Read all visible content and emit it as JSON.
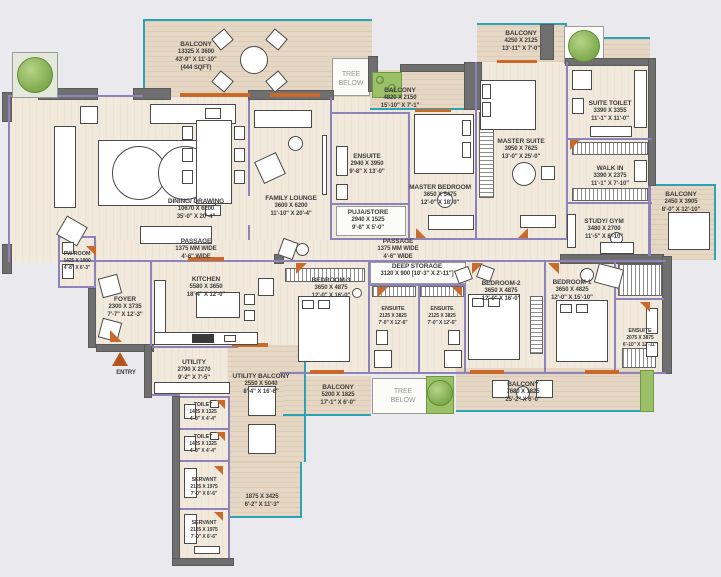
{
  "colors": {
    "bg": "#e9e9ee",
    "floor": "#f1e9dc",
    "balcony": "#e5d7c3",
    "wall": "#6f6f6f",
    "purple": "#8d82ba",
    "teal": "#2ba3b5",
    "orange": "#c96a2a",
    "entry": "#b5541f",
    "green": "#9cc068",
    "text": "#3c3c3c"
  },
  "labels": [
    {
      "id": "balcony-top-left",
      "x": 196,
      "y": 57,
      "lines": [
        "BALCONY",
        "13325 X 3600",
        "43'-9\" X 11'-10\"",
        "(444 SQFT)"
      ]
    },
    {
      "id": "tree-below-top",
      "x": 351,
      "y": 79,
      "cls": "muted",
      "title": false,
      "lines": [
        "TREE",
        "BELOW"
      ]
    },
    {
      "id": "balcony-master-bedroom",
      "x": 400,
      "y": 99,
      "lines": [
        "BALCONY",
        "4820 X 2150",
        "15'-10\" X 7'-1\""
      ]
    },
    {
      "id": "balcony-master-suite",
      "x": 521,
      "y": 42,
      "lines": [
        "BALCONY",
        "4250 X 2125",
        "13'-11\" X 7'-0\""
      ]
    },
    {
      "id": "suite-toilet",
      "x": 610,
      "y": 112,
      "lines": [
        "SUITE TOILET",
        "3390 X 3355",
        "11'-1\" X 11'-0\""
      ]
    },
    {
      "id": "dining-drawing",
      "x": 196,
      "y": 210,
      "lines": [
        "DINING/ DRAWING",
        "10670 X 6200",
        "35'-0\" X 20'-4\""
      ]
    },
    {
      "id": "family-lounge",
      "x": 291,
      "y": 207,
      "lines": [
        "FAMILY LOUNGE",
        "3600 X 6200",
        "11'-10\" X 20'-4\""
      ]
    },
    {
      "id": "ensuite-master",
      "x": 367,
      "y": 165,
      "lines": [
        "ENSUITE",
        "2940 X 3950",
        "9'-8\" X 13'-0\""
      ]
    },
    {
      "id": "puja-store",
      "x": 368,
      "y": 221,
      "lines": [
        "PUJA/STORE",
        "2940 X 1525",
        "9'-8\" X 5'-0\""
      ]
    },
    {
      "id": "master-bedroom",
      "x": 440,
      "y": 196,
      "lines": [
        "MASTER BEDROOM",
        "3650 X 5475",
        "12'-0\" X 18'-0\""
      ]
    },
    {
      "id": "master-suite",
      "x": 521,
      "y": 150,
      "lines": [
        "MASTER SUITE",
        "3950 X 7625",
        "13'-0\" X 25'-0\""
      ]
    },
    {
      "id": "walk-in",
      "x": 610,
      "y": 177,
      "lines": [
        "WALK IN",
        "3390 X 2375",
        "11'-1\" X 7'-10\""
      ]
    },
    {
      "id": "balcony-right",
      "x": 681,
      "y": 203,
      "lines": [
        "BALCONY",
        "2450 X 3905",
        "8'-0\" X 12'-10\""
      ]
    },
    {
      "id": "study-gym",
      "x": 604,
      "y": 230,
      "lines": [
        "STUDY/ GYM",
        "3480 X 2700",
        "11'-5\" X 8'-10\""
      ]
    },
    {
      "id": "passage-west",
      "x": 196,
      "y": 250,
      "lines": [
        "PASSAGE",
        "1375 MM WIDE",
        "4'-6\" WIDE"
      ]
    },
    {
      "id": "passage-east",
      "x": 398,
      "y": 250,
      "lines": [
        "PASSAGE",
        "1375 MM WIDE",
        "4'-6\" WIDE"
      ]
    },
    {
      "id": "pw-room",
      "x": 77,
      "y": 261,
      "cls": "small",
      "lines": [
        "PW ROOM",
        "1425 X 1900",
        "4'-8\" X 6'-3\""
      ]
    },
    {
      "id": "foyer",
      "x": 125,
      "y": 308,
      "lines": [
        "FOYER",
        "2300 X 3735",
        "7'-7\" X 12'-3\""
      ]
    },
    {
      "id": "kitchen",
      "x": 206,
      "y": 288,
      "lines": [
        "KITCHEN",
        "5580 X 3650",
        "18'-4\" X 12'-0\""
      ]
    },
    {
      "id": "deep-storage",
      "x": 417,
      "y": 271,
      "lines": [
        "DEEP STORAGE",
        "3120 X 900 [10'-3\" X 2'-11\"]"
      ]
    },
    {
      "id": "bedroom-3",
      "x": 331,
      "y": 289,
      "lines": [
        "BEDROOM-3",
        "3650 X 4875",
        "12'-0\" X 16'-0\""
      ]
    },
    {
      "id": "ensuite-bedroom-3",
      "x": 393,
      "y": 316,
      "cls": "small",
      "lines": [
        "ENSUITE",
        "2125 X 3825",
        "7'-0\" X 12'-6\""
      ]
    },
    {
      "id": "ensuite-bedroom-2",
      "x": 442,
      "y": 316,
      "cls": "small",
      "lines": [
        "ENSUITE",
        "2125 X 3825",
        "7'-0\" X 12'-6\""
      ]
    },
    {
      "id": "bedroom-2",
      "x": 501,
      "y": 292,
      "lines": [
        "BEDROOM-2",
        "3650 X 4875",
        "12'-0\" X 16'-0\""
      ]
    },
    {
      "id": "bedroom-1",
      "x": 572,
      "y": 291,
      "lines": [
        "BEDROOM-1",
        "3650 X 4825",
        "12'-0\" X 15'-10\""
      ]
    },
    {
      "id": "ensuite-bedroom-1",
      "x": 640,
      "y": 338,
      "cls": "small",
      "lines": [
        "ENSUITE",
        "2075 X 3875",
        "6'-10\" X 12'-11\""
      ]
    },
    {
      "id": "utility",
      "x": 194,
      "y": 371,
      "lines": [
        "UTILITY",
        "2790 X 2270",
        "9'-2\" X 7'-5\""
      ]
    },
    {
      "id": "utility-balcony",
      "x": 261,
      "y": 385,
      "lines": [
        "UTILITY BALCONY",
        "2550 X 5040",
        "8'-4\" X 16'-6\""
      ]
    },
    {
      "id": "entry",
      "x": 126,
      "y": 374,
      "lines": [
        "ENTRY"
      ]
    },
    {
      "id": "toilet-1",
      "x": 203,
      "y": 412,
      "cls": "small",
      "lines": [
        "TOILET",
        "1425 X 1325",
        "4'-8\" X 4'-4\""
      ]
    },
    {
      "id": "toilet-2",
      "x": 203,
      "y": 444,
      "cls": "small",
      "lines": [
        "TOILET",
        "1425 X 1325",
        "4'-8\" X 4'-4\""
      ]
    },
    {
      "id": "balcony-bottom-left",
      "x": 338,
      "y": 396,
      "lines": [
        "BALCONY",
        "5200 X 1825",
        "17'-1\" X 6'-0\""
      ]
    },
    {
      "id": "tree-below-bottom",
      "x": 403,
      "y": 396,
      "cls": "muted",
      "title": false,
      "lines": [
        "TREE",
        "BELOW"
      ]
    },
    {
      "id": "balcony-bottom-right",
      "x": 523,
      "y": 393,
      "lines": [
        "BALCONY",
        "7680 X 1825",
        "25'-2\" X 6'-0\""
      ]
    },
    {
      "id": "servant-1",
      "x": 204,
      "y": 487,
      "cls": "small",
      "lines": [
        "SERVANT",
        "2125 X 1975",
        "7'-0\" X 6'-6\""
      ]
    },
    {
      "id": "corridor-dims",
      "x": 262,
      "y": 502,
      "title": false,
      "lines": [
        "1875 X 3425",
        "6'-2\" X 11'-3\""
      ]
    },
    {
      "id": "servant-2",
      "x": 204,
      "y": 530,
      "cls": "small",
      "lines": [
        "SERVANT",
        "2125 X 1975",
        "7'-0\" X 6'-6\""
      ]
    }
  ]
}
